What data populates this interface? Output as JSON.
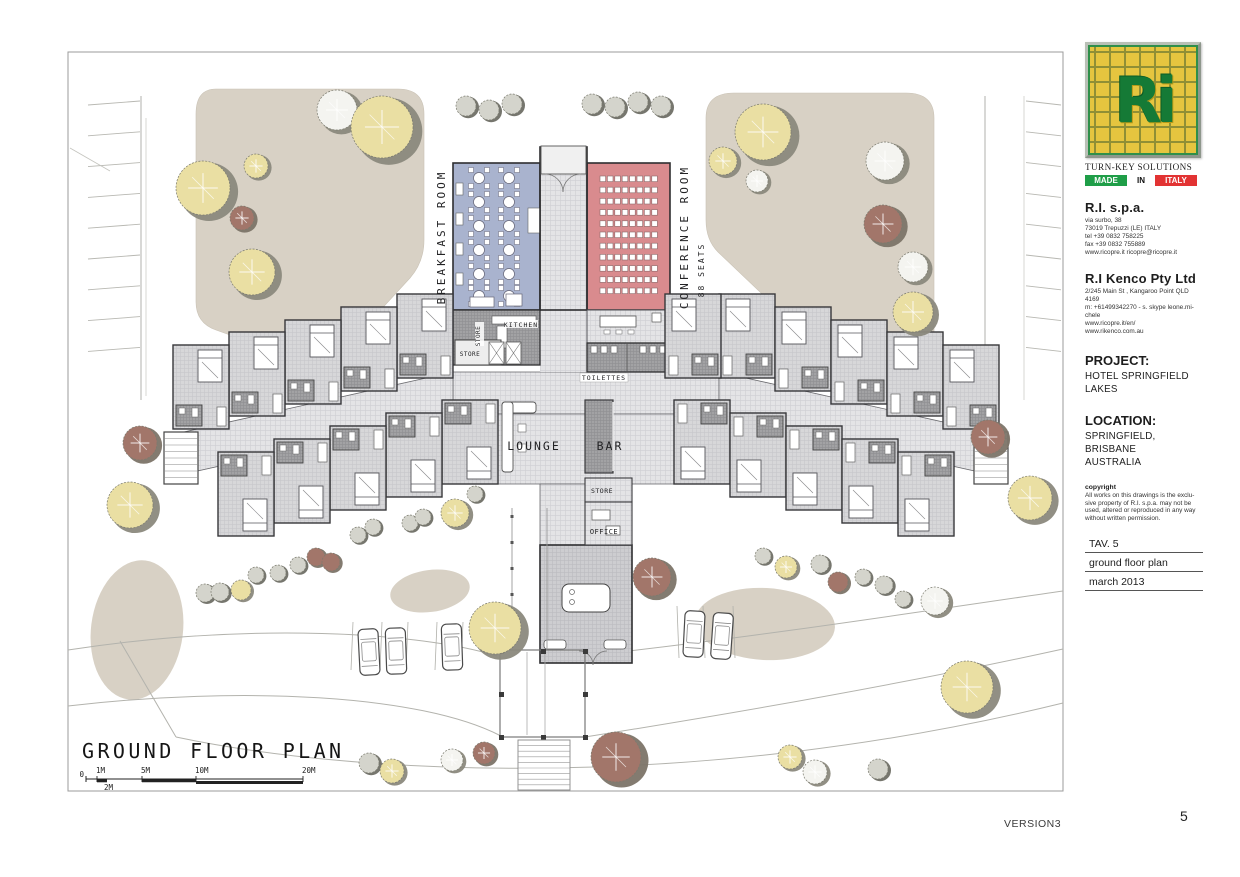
{
  "drawing_title": "GROUND FLOOR PLAN",
  "footer": {
    "version": "VERSION3",
    "page": "5"
  },
  "labels": {
    "breakfast_room": "BREAKFAST ROOM",
    "conference_room": "CONFERENCE ROOM",
    "conference_seats": "88 SEATS",
    "store_kitchen_vert": "STORE",
    "kitchen": "KITCHEN",
    "store_mid": "STORE",
    "toilettes": "TOILETTES",
    "lounge": "LOUNGE",
    "bar": "BAR",
    "store_lower": "STORE",
    "office": "OFFICE"
  },
  "scalebar": {
    "zero": "0",
    "below_label": "2M",
    "below_x": 104,
    "marks": [
      {
        "label": "1M",
        "x": 97
      },
      {
        "label": "5M",
        "x": 142
      },
      {
        "label": "10M",
        "x": 196
      },
      {
        "label": "20M",
        "x": 303
      }
    ]
  },
  "colors": {
    "breakfast": "#a9b3ce",
    "conference": "#d98b8e",
    "landscape": "#d8d1c5",
    "wall": "#2e2e30",
    "tree_yellow": "#eadfa3",
    "tree_white": "#f4f4f0",
    "tree_brown": "#a2766a",
    "tree_gray": "#d4d4cc",
    "fringe": "#8b897d",
    "fringe_dark": "#6f6f66"
  },
  "building": {
    "module_w": 56,
    "module_h": 84,
    "rows": [
      {
        "dir": "up",
        "mir": false,
        "xs": [
          397,
          341,
          285,
          229,
          173
        ],
        "ys": [
          294,
          307,
          320,
          332,
          345
        ]
      },
      {
        "dir": "down",
        "mir": false,
        "xs": [
          442,
          386,
          330,
          274,
          218
        ],
        "ys": [
          400,
          413,
          426,
          439,
          452
        ]
      },
      {
        "dir": "up",
        "mir": true,
        "xs": [
          719,
          775,
          831,
          887,
          943
        ],
        "ys": [
          294,
          307,
          320,
          332,
          345
        ]
      },
      {
        "dir": "down",
        "mir": true,
        "xs": [
          674,
          730,
          786,
          842,
          898
        ],
        "ys": [
          400,
          413,
          426,
          439,
          452
        ]
      },
      {
        "dir": "up",
        "mir": true,
        "xs": [
          665
        ],
        "ys": [
          294
        ]
      }
    ]
  },
  "trees": [
    [
      337,
      110,
      20,
      "w"
    ],
    [
      382,
      127,
      31,
      "y"
    ],
    [
      203,
      188,
      27,
      "y"
    ],
    [
      256,
      166,
      12,
      "y"
    ],
    [
      242,
      218,
      12,
      "b"
    ],
    [
      252,
      272,
      23,
      "y"
    ],
    [
      466,
      106,
      10,
      "g"
    ],
    [
      489,
      110,
      10,
      "g"
    ],
    [
      512,
      104,
      10,
      "g"
    ],
    [
      592,
      104,
      10,
      "g"
    ],
    [
      615,
      107,
      10,
      "g"
    ],
    [
      638,
      102,
      10,
      "g"
    ],
    [
      661,
      106,
      10,
      "g"
    ],
    [
      723,
      161,
      14,
      "y"
    ],
    [
      763,
      132,
      28,
      "y"
    ],
    [
      757,
      181,
      11,
      "w"
    ],
    [
      885,
      161,
      19,
      "w"
    ],
    [
      883,
      224,
      19,
      "b"
    ],
    [
      913,
      267,
      15,
      "w"
    ],
    [
      913,
      312,
      20,
      "y"
    ],
    [
      140,
      443,
      17,
      "b"
    ],
    [
      130,
      505,
      23,
      "y"
    ],
    [
      205,
      593,
      9,
      "g"
    ],
    [
      220,
      592,
      9,
      "g"
    ],
    [
      241,
      590,
      10,
      "y"
    ],
    [
      256,
      575,
      8,
      "g"
    ],
    [
      278,
      573,
      8,
      "g"
    ],
    [
      298,
      565,
      8,
      "g"
    ],
    [
      316,
      557,
      9,
      "b"
    ],
    [
      331,
      562,
      9,
      "b"
    ],
    [
      358,
      535,
      8,
      "g"
    ],
    [
      373,
      527,
      8,
      "g"
    ],
    [
      410,
      523,
      8,
      "g"
    ],
    [
      423,
      517,
      8,
      "g"
    ],
    [
      455,
      513,
      14,
      "y"
    ],
    [
      475,
      494,
      8,
      "g"
    ],
    [
      495,
      628,
      26,
      "y"
    ],
    [
      616,
      757,
      25,
      "b"
    ],
    [
      652,
      577,
      19,
      "b"
    ],
    [
      763,
      556,
      8,
      "g"
    ],
    [
      786,
      567,
      11,
      "y"
    ],
    [
      820,
      564,
      9,
      "g"
    ],
    [
      838,
      582,
      10,
      "b"
    ],
    [
      863,
      577,
      8,
      "g"
    ],
    [
      884,
      585,
      9,
      "g"
    ],
    [
      903,
      599,
      8,
      "g"
    ],
    [
      935,
      601,
      14,
      "w"
    ],
    [
      967,
      687,
      26,
      "y"
    ],
    [
      988,
      437,
      17,
      "b"
    ],
    [
      1030,
      498,
      22,
      "y"
    ],
    [
      369,
      763,
      10,
      "g"
    ],
    [
      392,
      771,
      12,
      "y"
    ],
    [
      452,
      760,
      11,
      "w"
    ],
    [
      484,
      753,
      11,
      "b"
    ],
    [
      790,
      757,
      12,
      "y"
    ],
    [
      815,
      772,
      12,
      "w"
    ],
    [
      878,
      769,
      10,
      "g"
    ]
  ],
  "cars": [
    [
      359,
      629,
      -3
    ],
    [
      386,
      628,
      -2
    ],
    [
      442,
      624,
      -2
    ],
    [
      684,
      611,
      3
    ],
    [
      712,
      613,
      4
    ]
  ],
  "title_block": {
    "logo": {
      "monogram": "Ri",
      "tagline": "TURN-KEY SOLUTIONS",
      "made": "MADE",
      "in": "IN",
      "italy": "ITALY"
    },
    "company_it": {
      "name": "R.I. s.p.a.",
      "lines": [
        "via surbo, 38",
        "73019 Trepuzzi (LE) ITALY",
        "tel +39 0832 758225",
        "fax +39 0832 755889",
        "www.ricopre.it    ricopre@ricopre.it"
      ]
    },
    "company_au": {
      "name": "R.I Kenco Pty Ltd",
      "lines": [
        "2/245 Main St , Kangaroo Point  QLD",
        "4169",
        "m: +61499342270 - s. skype  leone.mi-",
        "chele",
        "www.ricopre.it/en/",
        "www.rikenco.com.au"
      ]
    },
    "project": {
      "label": "PROJECT:",
      "lines": [
        "HOTEL SPRINGFIELD",
        "LAKES"
      ]
    },
    "location": {
      "label": "LOCATION:",
      "lines": [
        "SPRINGFIELD,",
        "BRISBANE",
        "AUSTRALIA"
      ]
    },
    "copyright": {
      "label": "copyright",
      "lines": [
        "All works on this drawings is the exclu-",
        "sive property of R.I. s.p.a. may not be",
        "used, altered or reproduced in any way",
        "without written permission."
      ]
    },
    "revision": {
      "tav": "TAV. 5",
      "name": "ground floor plan",
      "date": "march 2013"
    }
  }
}
